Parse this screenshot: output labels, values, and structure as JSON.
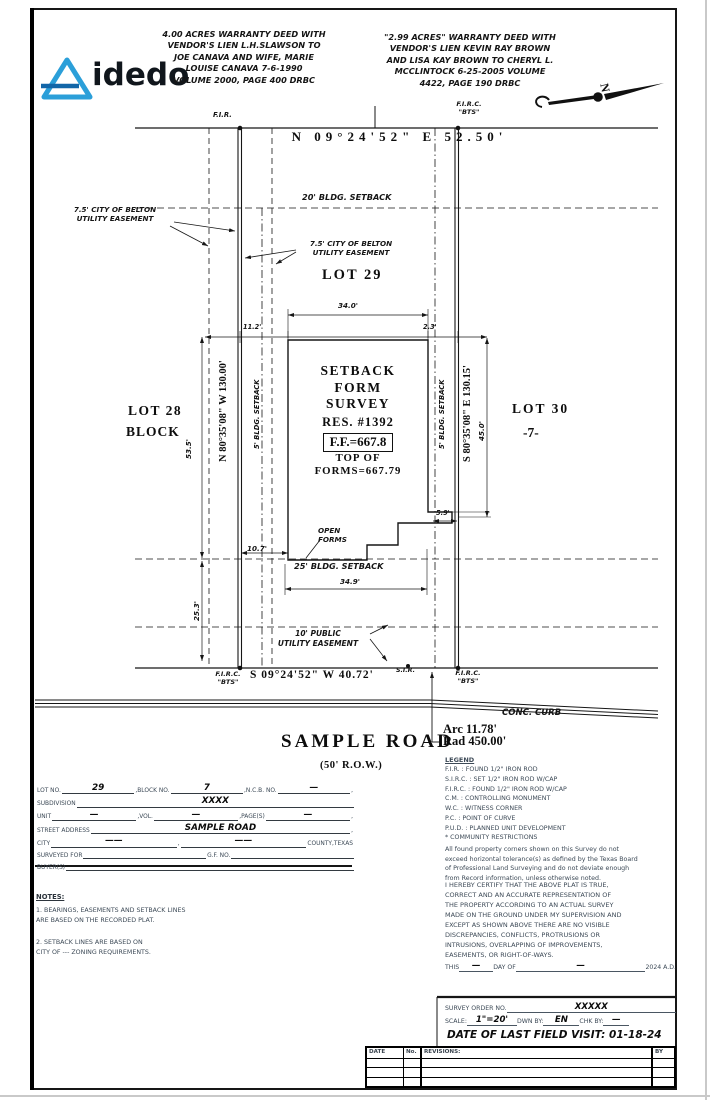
{
  "colors": {
    "logo_blue": "#2b9fd9",
    "logo_dark_blue": "#1266a8",
    "ink": "#151515",
    "doc_text": "#3d4a57"
  },
  "logo": {
    "brand": "idedo"
  },
  "header": {
    "deed_left": "4.00 ACRES WARRANTY DEED WITH\nVENDOR'S LIEN L.H.SLAWSON TO\nJOE CANAVA AND WIFE, MARIE\nLOUISE CANAVA 7-6-1990\nVOLUME 2000, PAGE 400 DRBC",
    "deed_right": "\"2.99 ACRES\" WARRANTY DEED WITH\nVENDOR'S LIEN KEVIN RAY BROWN\nAND LISA KAY BROWN TO CHERYL L.\nMCCLINTOCK 6-25-2005 VOLUME\n4422, PAGE 190 DRBC",
    "north_letter": "N"
  },
  "plat": {
    "bearing_top": "N 09°24'52\" E 52.50'",
    "fir": "F.I.R.",
    "firc": "F.I.R.C.\n\"BTS\"",
    "setback_20": "20' BLDG. SETBACK",
    "easement_7_5": "7.5' CITY OF BELTON\nUTILITY EASEMENT",
    "lot_29": "LOT 29",
    "lot_28": "LOT 28",
    "block_word": "BLOCK",
    "lot_30": "LOT 30",
    "block_7": "-7-",
    "dim_34_0": "34.0'",
    "dim_11_2": "11.2'",
    "dim_2_3": "2.3'",
    "bearing_left": "N 80°35'08\" W 130.00'",
    "dim_53_5": "53.5'",
    "setback_5": "5' BLDG. SETBACK",
    "survey_title": "SETBACK\nFORM\nSURVEY",
    "res_no": "RES.  #1392",
    "ff": "F.F.=667.8",
    "top_of_forms": "TOP OF\nFORMS=667.79",
    "bearing_right": "S 80°35'08\" E 130.15'",
    "dim_45_0": "45.0'",
    "dim_5_9": "5.9'",
    "open_forms": "OPEN\nFORMS",
    "dim_10_7": "10.7'",
    "setback_25": "25' BLDG. SETBACK",
    "dim_34_9": "34.9'",
    "dim_25_3": "25.3'",
    "pue_10": "10' PUBLIC\nUTILITY EASEMENT",
    "bearing_bottom": "S 09°24'52\" W 40.72'",
    "sir": "S.I.R.",
    "conc_curb": "CONC. CURB",
    "arc": "Arc 11.78'\nRad 450.00'",
    "road_name": "SAMPLE ROAD",
    "row": "(50' R.O.W.)"
  },
  "legend": {
    "title": "LEGEND",
    "lines": "F.I.R. : FOUND 1/2\" IRON ROD\nS.I.R.C. : SET 1/2\" IRON ROD W/CAP\nF.I.R.C. : FOUND 1/2\" IRON ROD W/CAP\nC.M. : CONTROLLING MONUMENT\nW.C. : WITNESS CORNER\nP.C. : POINT OF CURVE\nP.U.D. : PLANNED UNIT DEVELOPMENT\n* COMMUNITY RESTRICTIONS",
    "tolerance_note": "All found property corners shown on this Survey do not\nexceed horizontal tolerance(s) as defined by the Texas Board\nof Professional Land Surveying and do not deviate enough\nfrom Record information, unless otherwise noted.",
    "certification": "I HEREBY CERTIFY THAT THE ABOVE PLAT  IS TRUE,\nCORRECT AND AN ACCURATE  REPRESENTATION  OF\nTHE PROPERTY ACCORDING TO AN ACTUAL SURVEY\nMADE ON THE GROUND UNDER MY SUPERVISION AND\nEXCEPT AS SHOWN ABOVE THERE ARE NO VISIBLE\nDISCREPANCIES, CONFLICTS, PROTRUSIONS OR\nINTRUSIONS, OVERLAPPING OF IMPROVEMENTS,\nEASEMENTS, OR RIGHT-OF-WAYS.",
    "date_line": {
      "this": "THIS",
      "blank1": "—",
      "day_of": "DAY OF",
      "blank2": "—",
      "year": "2024 A.D."
    }
  },
  "order_block": {
    "survey_order_label": "SURVEY ORDER NO.",
    "survey_order_no": "XXXXX",
    "scale_label": "SCALE:",
    "scale": "1\"=20'",
    "dwn_by_label": "DWN BY:",
    "dwn_by": "EN",
    "chk_by_label": "CHK BY:",
    "chk_by": "—",
    "field_visit": "DATE OF LAST FIELD VISIT: 01-18-24"
  },
  "form": {
    "rows": [
      [
        {
          "k": "l",
          "t": "LOT NO."
        },
        {
          "k": "v",
          "t": "29"
        },
        {
          "k": "l",
          "t": ",BLOCK NO."
        },
        {
          "k": "v",
          "t": "7"
        },
        {
          "k": "l",
          "t": ",N.C.B. NO."
        },
        {
          "k": "v",
          "t": "—"
        },
        {
          "k": "l",
          "t": ","
        }
      ],
      [
        {
          "k": "l",
          "t": "SUBDIVISION"
        },
        {
          "k": "v",
          "t": "XXXX"
        }
      ],
      [
        {
          "k": "l",
          "t": "UNIT"
        },
        {
          "k": "v",
          "t": "—"
        },
        {
          "k": "l",
          "t": ",VOL."
        },
        {
          "k": "v",
          "t": "—"
        },
        {
          "k": "l",
          "t": ",PAGE(S)"
        },
        {
          "k": "v",
          "t": "—"
        },
        {
          "k": "l",
          "t": ","
        }
      ],
      [
        {
          "k": "l",
          "t": "STREET ADDRESS"
        },
        {
          "k": "v",
          "t": "SAMPLE ROAD"
        },
        {
          "k": "l",
          "t": ","
        }
      ],
      [
        {
          "k": "l",
          "t": "CITY"
        },
        {
          "k": "v",
          "t": "——"
        },
        {
          "k": "l",
          "t": ","
        },
        {
          "k": "v",
          "t": "——"
        },
        {
          "k": "l",
          "t": "COUNTY,TEXAS"
        }
      ],
      [
        {
          "k": "l",
          "t": "SURVEYED FOR"
        },
        {
          "k": "v",
          "t": ""
        },
        {
          "k": "l",
          "t": "G.F. NO."
        },
        {
          "k": "v",
          "t": ""
        }
      ],
      [
        {
          "k": "l",
          "t": "BUYER(S)"
        },
        {
          "k": "v",
          "t": ""
        }
      ]
    ]
  },
  "notes": {
    "title": "NOTES:",
    "note1": "1. BEARINGS, EASEMENTS AND SETBACK LINES\n    ARE BASED ON THE RECORDED PLAT.",
    "note2": "2. SETBACK LINES ARE BASED ON\n    CITY OF --- ZONING REQUIREMENTS."
  },
  "revision_table": {
    "headers": [
      "DATE",
      "No.",
      "REVISIONS:",
      "BY"
    ],
    "rows": 3
  }
}
